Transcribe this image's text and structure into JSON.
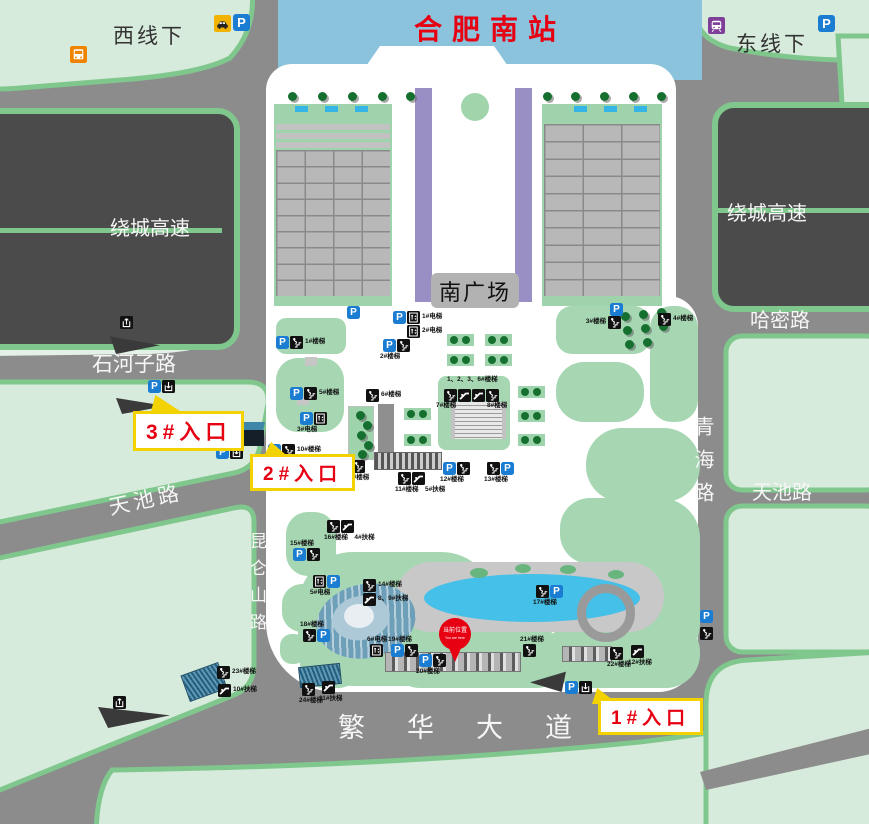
{
  "banner": {
    "title": "合肥南站"
  },
  "areas": {
    "west_line": "西线下",
    "east_line": "东线下",
    "ring_left": "绕城高速",
    "ring_right": "绕城高速",
    "south_plaza": "南广场"
  },
  "roads": {
    "shihezi": "石河子路",
    "hami": "哈密路",
    "qinghai": "青海路",
    "tianchi_left": "天池路",
    "tianchi_right": "天池路",
    "kunlunshan": "昆仑山路",
    "fanhua": "繁华大道"
  },
  "entrances": [
    {
      "id": "entrance-1",
      "label": "1#入口"
    },
    {
      "id": "entrance-2",
      "label": "2#入口"
    },
    {
      "id": "entrance-3",
      "label": "3#入口"
    }
  ],
  "location_pin": {
    "line1": "当前位置",
    "line2": "You are here"
  },
  "icon_glyphs": {
    "parking": "P"
  },
  "colors": {
    "road": "#8c8c8c",
    "block_green": "#d7ebdc",
    "block_border": "#7fc78d",
    "dark_block": "#4b4b4b",
    "banner_blue": "#8cc3dc",
    "accent_red": "#e60012",
    "lawn": "#a6d7b2",
    "parking_blue": "#1b7dd2",
    "callout_yellow": "#f2d200",
    "purple_column": "#9a8fc5",
    "pond_blue": "#45c0e8"
  },
  "transport": [
    {
      "type": "taxi",
      "x": 214,
      "y": 15
    },
    {
      "type": "parking",
      "x": 233,
      "y": 14
    },
    {
      "type": "bus",
      "x": 70,
      "y": 46
    },
    {
      "type": "metro",
      "x": 708,
      "y": 17
    },
    {
      "type": "parking",
      "x": 818,
      "y": 15
    }
  ],
  "facilities": [
    {
      "x": 347,
      "y": 306,
      "icons": [
        "parking"
      ]
    },
    {
      "x": 276,
      "y": 336,
      "icons": [
        "parking",
        "stairs"
      ],
      "label": "1#楼梯",
      "side": "right"
    },
    {
      "x": 393,
      "y": 311,
      "icons": [
        "parking",
        "elevator"
      ],
      "label": "1#电梯",
      "side": "right"
    },
    {
      "x": 407,
      "y": 325,
      "icons": [
        "elevator"
      ],
      "label": "2#电梯",
      "side": "right"
    },
    {
      "x": 383,
      "y": 339,
      "icons": [
        "parking",
        "stairs"
      ],
      "label": "2#楼梯",
      "side": "below"
    },
    {
      "x": 610,
      "y": 303,
      "icons": [
        "parking"
      ]
    },
    {
      "x": 608,
      "y": 316,
      "icons": [
        "stairs"
      ],
      "label": "3#楼梯",
      "side": "left"
    },
    {
      "x": 658,
      "y": 313,
      "icons": [
        "stairs"
      ],
      "label": "4#楼梯",
      "side": "right"
    },
    {
      "x": 290,
      "y": 387,
      "icons": [
        "parking",
        "stairs"
      ],
      "label": "5#楼梯",
      "side": "right"
    },
    {
      "x": 366,
      "y": 389,
      "icons": [
        "stairs"
      ],
      "label": "6#楼梯",
      "side": "right"
    },
    {
      "x": 447,
      "y": 376,
      "icons": [],
      "label": "1、2、3、6#楼梯"
    },
    {
      "x": 444,
      "y": 389,
      "icons": [
        "stairs",
        "escalator",
        "escalator",
        "stairs"
      ]
    },
    {
      "x": 436,
      "y": 402,
      "icons": [],
      "label": "7#楼梯"
    },
    {
      "x": 487,
      "y": 402,
      "icons": [],
      "label": "8#楼梯"
    },
    {
      "x": 300,
      "y": 412,
      "icons": [
        "parking",
        "elevator"
      ],
      "label": "3#电梯",
      "side": "below"
    },
    {
      "x": 268,
      "y": 444,
      "icons": [
        "parking",
        "stairs"
      ],
      "label": "10#楼梯",
      "side": "right"
    },
    {
      "x": 352,
      "y": 460,
      "icons": [
        "stairs"
      ],
      "label": "9#楼梯",
      "side": "below"
    },
    {
      "x": 398,
      "y": 472,
      "icons": [
        "stairs",
        "escalator"
      ],
      "label": "11#楼梯",
      "label2": "5#扶梯",
      "side": "below"
    },
    {
      "x": 443,
      "y": 462,
      "icons": [
        "parking",
        "stairs"
      ],
      "label": "12#楼梯",
      "side": "below"
    },
    {
      "x": 487,
      "y": 462,
      "icons": [
        "stairs",
        "parking"
      ],
      "label": "13#楼梯",
      "side": "below"
    },
    {
      "x": 293,
      "y": 548,
      "icons": [
        "parking",
        "stairs"
      ],
      "label": "15#楼梯",
      "side": "above"
    },
    {
      "x": 327,
      "y": 520,
      "icons": [
        "stairs",
        "escalator"
      ],
      "label": "16#楼梯",
      "label2": "4#扶梯",
      "side": "below"
    },
    {
      "x": 313,
      "y": 575,
      "icons": [
        "elevator",
        "parking"
      ],
      "label": "5#电梯",
      "side": "below"
    },
    {
      "x": 363,
      "y": 579,
      "icons": [
        "stairs"
      ],
      "label": "14#楼梯",
      "side": "right"
    },
    {
      "x": 363,
      "y": 593,
      "icons": [
        "escalator"
      ],
      "label": "8、9#扶梯",
      "side": "right"
    },
    {
      "x": 303,
      "y": 629,
      "icons": [
        "stairs",
        "parking"
      ],
      "label": "18#楼梯",
      "side": "above"
    },
    {
      "x": 370,
      "y": 644,
      "icons": [
        "elevator"
      ],
      "label": "6#电梯",
      "side": "above"
    },
    {
      "x": 391,
      "y": 644,
      "icons": [
        "parking",
        "stairs"
      ],
      "label": "19#楼梯",
      "side": "above"
    },
    {
      "x": 419,
      "y": 654,
      "icons": [
        "parking",
        "stairs"
      ],
      "label": "20#楼梯",
      "side": "below"
    },
    {
      "x": 523,
      "y": 644,
      "icons": [
        "stairs"
      ],
      "label": "21#楼梯",
      "side": "above"
    },
    {
      "x": 536,
      "y": 585,
      "icons": [
        "stairs",
        "parking"
      ],
      "label": "17#楼梯",
      "side": "below"
    },
    {
      "x": 610,
      "y": 647,
      "icons": [
        "stairs"
      ],
      "label": "22#楼梯",
      "side": "below"
    },
    {
      "x": 631,
      "y": 645,
      "icons": [
        "escalator"
      ],
      "label": "12#扶梯",
      "side": "below"
    },
    {
      "x": 217,
      "y": 666,
      "icons": [
        "stairs"
      ],
      "label": "23#楼梯",
      "side": "right"
    },
    {
      "x": 218,
      "y": 684,
      "icons": [
        "escalator"
      ],
      "label": "10#扶梯",
      "side": "right"
    },
    {
      "x": 302,
      "y": 683,
      "icons": [
        "stairs"
      ],
      "label": "24#楼梯",
      "side": "below"
    },
    {
      "x": 322,
      "y": 681,
      "icons": [
        "escalator"
      ],
      "label": "11#扶梯",
      "side": "below"
    },
    {
      "x": 120,
      "y": 316,
      "icons": [
        "exit"
      ]
    },
    {
      "x": 148,
      "y": 380,
      "icons": [
        "parking",
        "entrance"
      ]
    },
    {
      "x": 216,
      "y": 446,
      "icons": [
        "parking",
        "entrance"
      ]
    },
    {
      "x": 565,
      "y": 681,
      "icons": [
        "parking",
        "entrance"
      ]
    },
    {
      "x": 113,
      "y": 696,
      "icons": [
        "exit"
      ]
    },
    {
      "x": 700,
      "y": 610,
      "icons": [
        "parking"
      ]
    },
    {
      "x": 700,
      "y": 627,
      "icons": [
        "stairs"
      ]
    }
  ]
}
